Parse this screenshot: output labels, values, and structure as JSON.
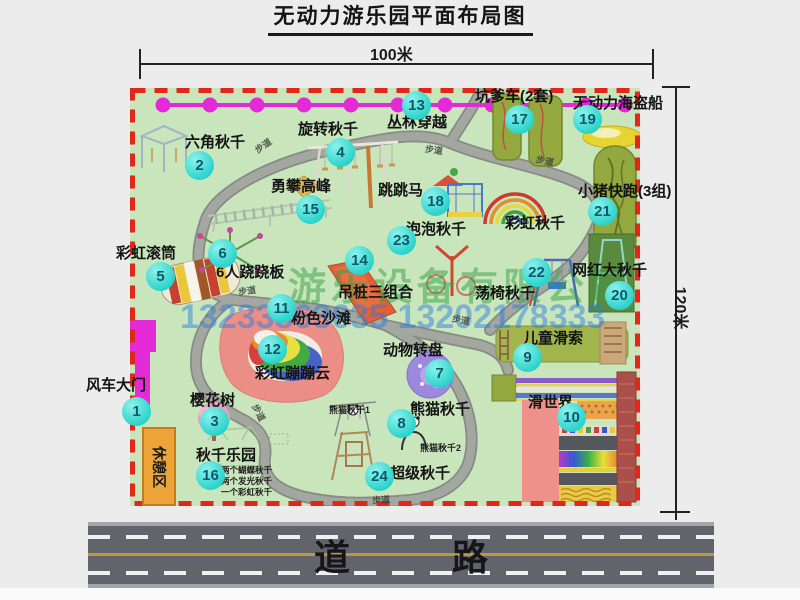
{
  "title": "无动力游乐园平面布局图",
  "dimensions": {
    "top": "100米",
    "right": "120米"
  },
  "road": {
    "label": "道  路"
  },
  "watermark": {
    "company": "游乐设备有限公司",
    "phone": "13233863635 13202178333"
  },
  "rest_area": "休憩区",
  "walkway": "步道",
  "extra": {
    "rainbow_swing": "彩虹秋千",
    "panda_swing_1": "熊猫秋千1",
    "panda_swing_2": "熊猫秋千2",
    "swing_park_notes": [
      "两个蝴蝶秋千",
      "两个发光秋千",
      "一个彩虹秋千"
    ]
  },
  "attractions": [
    {
      "num": "1",
      "name": "风车大门"
    },
    {
      "num": "2",
      "name": "六角秋千"
    },
    {
      "num": "3",
      "name": "樱花树"
    },
    {
      "num": "4",
      "name": "旋转秋千"
    },
    {
      "num": "5",
      "name": "彩虹滚筒"
    },
    {
      "num": "6",
      "name": "6人跷跷板"
    },
    {
      "num": "7",
      "name": "动物转盘"
    },
    {
      "num": "8",
      "name": "熊猫秋千"
    },
    {
      "num": "9",
      "name": "儿童滑索"
    },
    {
      "num": "10",
      "name": "滑世界"
    },
    {
      "num": "11",
      "name": "粉色沙滩"
    },
    {
      "num": "12",
      "name": "彩虹蹦蹦云"
    },
    {
      "num": "13",
      "name": "丛林穿越"
    },
    {
      "num": "14",
      "name": "吊桩三组合"
    },
    {
      "num": "15",
      "name": "勇攀高峰"
    },
    {
      "num": "16",
      "name": "秋千乐园"
    },
    {
      "num": "17",
      "name": "坑爹车(2套)"
    },
    {
      "num": "18",
      "name": "跳跳马"
    },
    {
      "num": "19",
      "name": "无动力海盗船"
    },
    {
      "num": "20",
      "name": "网红大秋千"
    },
    {
      "num": "21",
      "name": "小猪快跑(3组)"
    },
    {
      "num": "22",
      "name": "荡椅秋千"
    },
    {
      "num": "23",
      "name": "泡泡秋千"
    },
    {
      "num": "24",
      "name": "超级秋千"
    }
  ],
  "colors": {
    "map_green": "#c9e5bc",
    "border_red": "#e02818",
    "badge_teal": "#29d3cb",
    "zipline_magenta": "#e32ad6",
    "road_gray": "#63646b",
    "watermark_green": "#33a043",
    "watermark_blue": "#2a7de0"
  }
}
